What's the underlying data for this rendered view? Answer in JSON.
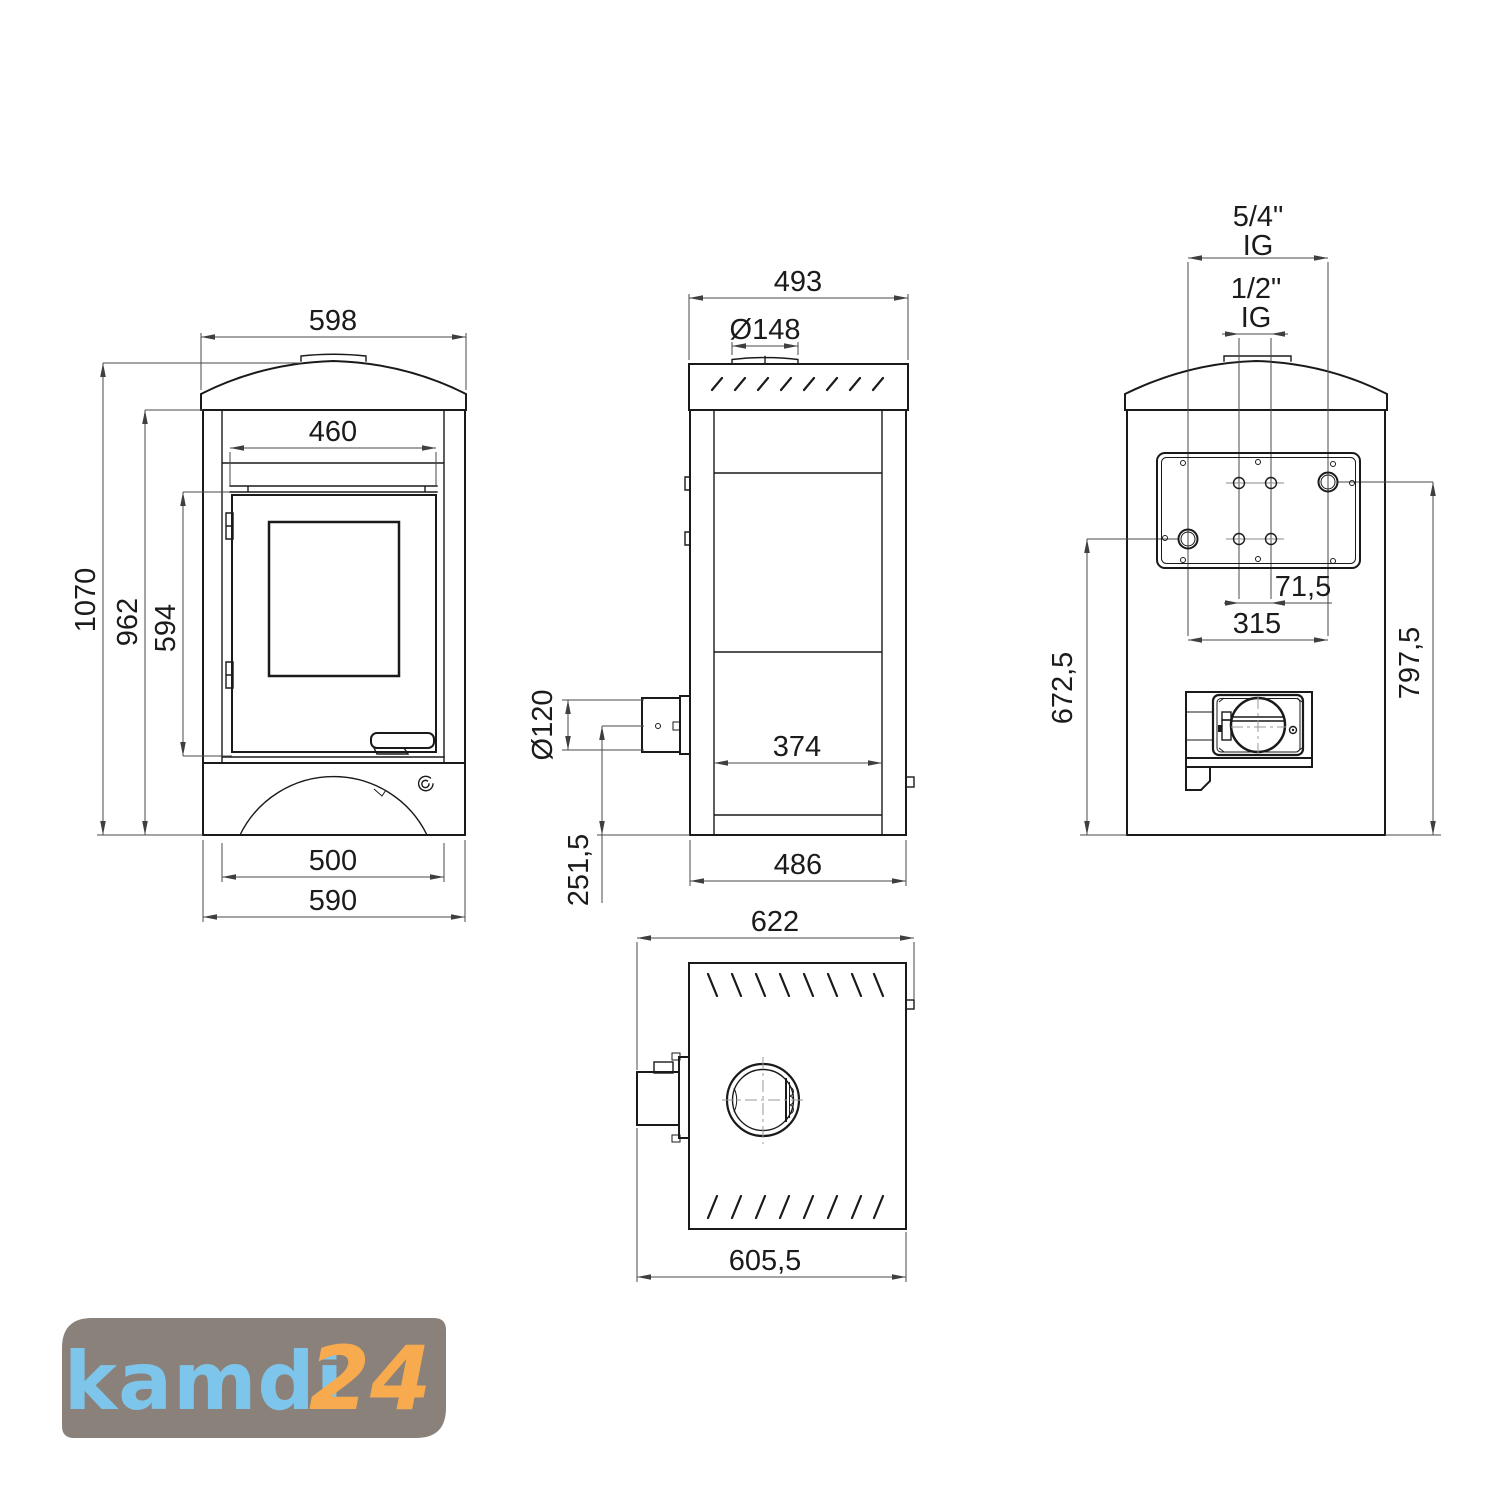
{
  "drawing": {
    "kind": "technical dimensional drawing",
    "subject": "water-bearing wood stove, four orthographic views"
  },
  "views": {
    "front": {
      "dims": {
        "cap_width": "598",
        "door_width": "460",
        "total_height": "1070",
        "body_height": "962",
        "door_height": "594",
        "base_inner_width": "500",
        "base_width": "590"
      }
    },
    "side": {
      "dims": {
        "top_depth": "493",
        "flue_collar_diameter": "Ø148",
        "rear_pipe_diameter": "Ø120",
        "firebox_depth": "374",
        "pipe_center_height": "251,5",
        "base_depth": "486"
      }
    },
    "back": {
      "dims": {
        "socket_large_size": "5/4\"",
        "socket_large_thread": "IG",
        "socket_small_size": "1/2\"",
        "socket_small_thread": "IG",
        "socket_small_spacing": "71,5",
        "socket_large_spacing": "315",
        "socket_left_height": "672,5",
        "socket_right_height": "797,5"
      }
    },
    "top": {
      "dims": {
        "total_depth": "622",
        "body_depth": "605,5"
      }
    }
  },
  "logo": {
    "brand": "kamdi",
    "suffix": "24",
    "bg": "#8a827a",
    "brand_color": "#7ec5eb",
    "suffix_color": "#f8aa4e"
  },
  "colors": {
    "line": "#1a1a1a",
    "dimension_line": "#4a4a4a",
    "background": "#ffffff"
  }
}
